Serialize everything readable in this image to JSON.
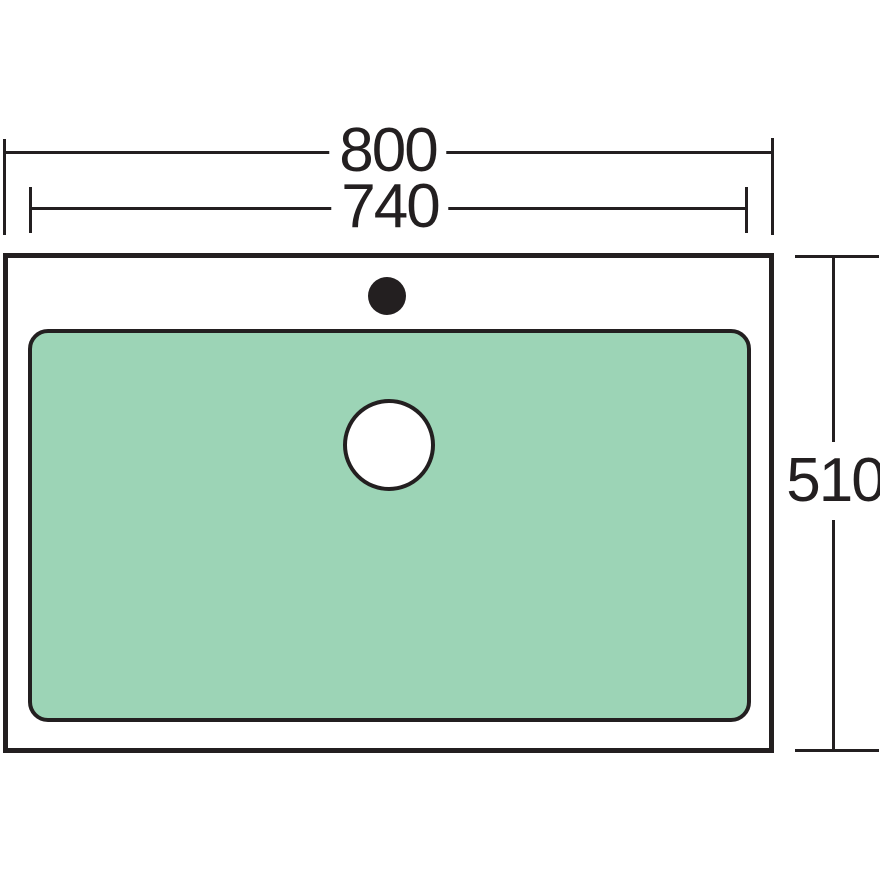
{
  "drawing": {
    "title": "Sink plan view technical drawing",
    "dimensions": {
      "overall_width": "800",
      "bowl_width": "740",
      "overall_depth": "510"
    },
    "colors": {
      "line": "#231F20",
      "bowl_fill": "#9CD4B6",
      "background": "#FFFFFF"
    }
  }
}
